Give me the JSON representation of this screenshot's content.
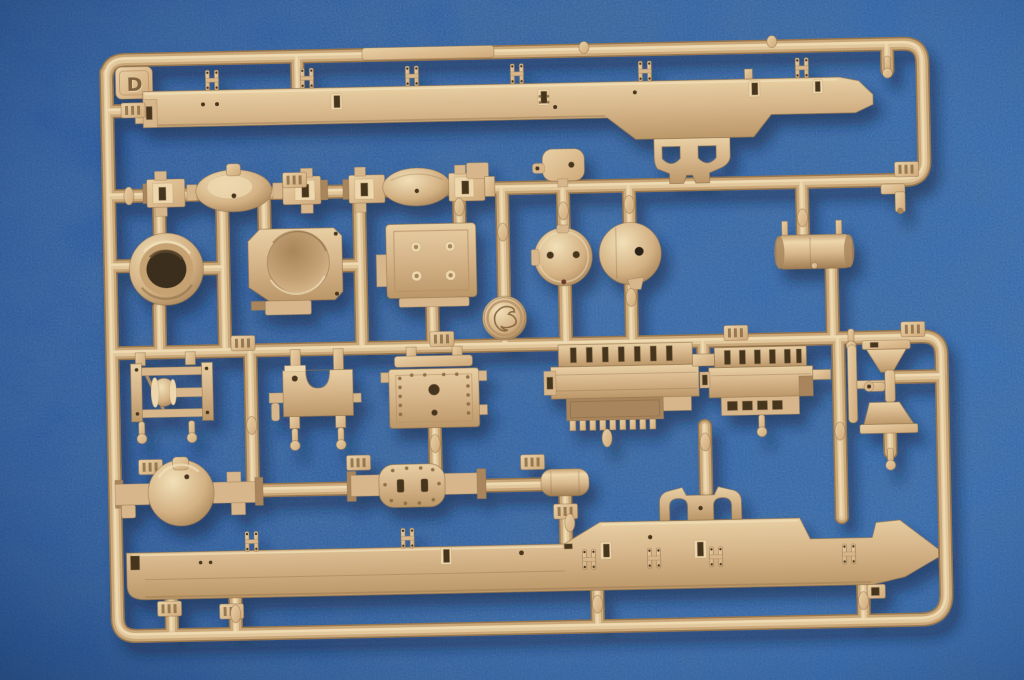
{
  "scene": {
    "type": "photograph",
    "subject": "Injection-molded plastic model kit sprue (parts tree) lying on blue textured paper background",
    "sprue_letter": "D",
    "plastic_material": "dark-yellow tan styrene",
    "colors": {
      "background_blue": "#2e5f9f",
      "background_blue_dark": "#1c4784",
      "background_blue_light": "#3f70b0",
      "plastic_base": "#d7b68b",
      "plastic_highlight": "#eed7ad",
      "plastic_shadow": "#a8855b",
      "plastic_outline": "#8a6c47",
      "recess_dark": "#44341f",
      "cast_shadow": "#0a1b3c"
    },
    "parts": [
      {
        "id": "sprue-frame",
        "label": "rectangular runner frame with rounded corners and letter tab"
      },
      {
        "id": "letter-tab",
        "label": "embossed identification tab reading D"
      },
      {
        "id": "top-chassis-rail",
        "label": "long ladder-frame side rail with clamp lugs, slots and angled tip"
      },
      {
        "id": "tow-arch-bracket-top",
        "label": "double-arch bracket hanging under top rail"
      },
      {
        "id": "front-axle-a",
        "label": "steering front axle with central bulge and knuckle ends"
      },
      {
        "id": "front-axle-b",
        "label": "second steering front axle"
      },
      {
        "id": "brake-drum-ring",
        "label": "open drum ring"
      },
      {
        "id": "transfer-case-dish",
        "label": "square housing with deep circular recess"
      },
      {
        "id": "bolted-plate",
        "label": "rectangular plate with four bolt heads"
      },
      {
        "id": "small-link-bracket",
        "label": "small rounded link bracket on upper runner"
      },
      {
        "id": "disc-two-holes",
        "label": "flat circular cover with two holes"
      },
      {
        "id": "domed-disc",
        "label": "domed circular cover with single hole"
      },
      {
        "id": "air-tank",
        "label": "horizontal cylindrical reservoir with two lugs"
      },
      {
        "id": "elbow-fitting",
        "label": "small L-shaped fitting near right runner"
      },
      {
        "id": "logo-medallion",
        "label": "round medallion with embossed maker emblem"
      },
      {
        "id": "winch-assembly",
        "label": "winch frame with cable drum"
      },
      {
        "id": "u-notch-bracket",
        "label": "bracket with U-shaped cutout"
      },
      {
        "id": "riveted-plate",
        "label": "plate with rivet rows and centre hole"
      },
      {
        "id": "engine-block-a",
        "label": "engine half with ribbed top and toothed rack"
      },
      {
        "id": "engine-block-b",
        "label": "engine half with ribbed top and louvred tray"
      },
      {
        "id": "funnel-bracket-upper",
        "label": "trapezoidal mount"
      },
      {
        "id": "pipe-elbow",
        "label": "short pipe with side branch and flange"
      },
      {
        "id": "funnel-bracket-lower",
        "label": "inverted trapezoidal mount"
      },
      {
        "id": "rear-axle-ball",
        "label": "rear axle with spherical differential housing"
      },
      {
        "id": "rear-axle-flat",
        "label": "rear axle with oval riveted cover"
      },
      {
        "id": "muffler",
        "label": "small oval canister"
      },
      {
        "id": "bottom-chassis-rail",
        "label": "long ladder-frame side rail with raised hump and ski-shaped tip"
      },
      {
        "id": "tow-arch-bracket-bottom",
        "label": "double-arch bracket standing on lower rail"
      },
      {
        "id": "sprue-gates",
        "label": "ribbed injection gate blocks on runners"
      },
      {
        "id": "ejector-pins",
        "label": "small spindles, nubs and ball-tip pins on runners"
      }
    ]
  }
}
